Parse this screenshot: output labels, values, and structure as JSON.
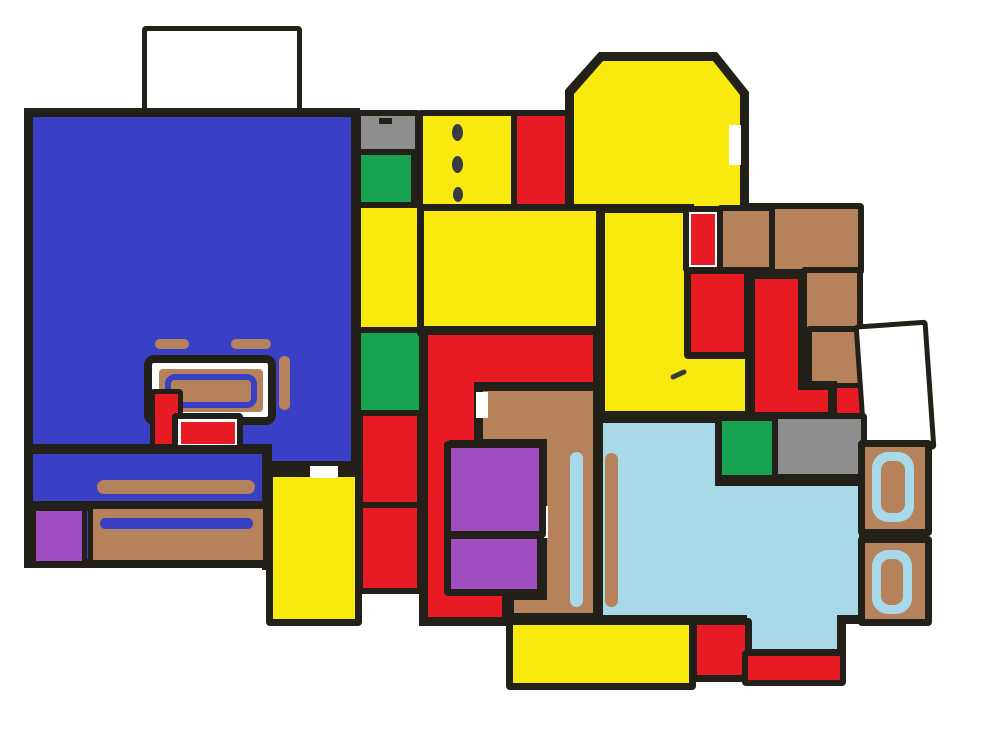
{
  "canvas": {
    "width": 985,
    "height": 749,
    "background": "#ffffff"
  },
  "palette": {
    "wall": "#23201a",
    "blue": "#3a40c6",
    "yellow": "#f8e90e",
    "red": "#e81b24",
    "green": "#17a351",
    "gray": "#8e8e8e",
    "brown": "#b5825c",
    "purple": "#9e4cc0",
    "pool": "#a7d9e9",
    "white": "#ffffff",
    "ink": "#3a3a42"
  },
  "regions": [
    {
      "name": "hatched-area-top",
      "kind": "rect",
      "rect": [
        142,
        26,
        160,
        90
      ],
      "color": "white",
      "border": 5,
      "hatch": "a"
    },
    {
      "name": "blue-great-room",
      "kind": "poly",
      "color": "blue",
      "outer": [
        [
          24,
          108
        ],
        [
          360,
          108
        ],
        [
          360,
          470
        ],
        [
          271,
          470
        ],
        [
          271,
          568
        ],
        [
          24,
          568
        ]
      ],
      "inner": [
        [
          33,
          117
        ],
        [
          351,
          117
        ],
        [
          351,
          461
        ],
        [
          262,
          461
        ],
        [
          262,
          559
        ],
        [
          33,
          559
        ]
      ]
    },
    {
      "name": "yellow-room-bottom-left",
      "kind": "rect",
      "rect": [
        266,
        470,
        96,
        156
      ],
      "color": "yellow",
      "border": 7
    },
    {
      "name": "blue-room-inner-wall-h1",
      "kind": "rect",
      "rect": [
        26,
        444,
        246,
        10
      ],
      "color": "wall"
    },
    {
      "name": "blue-room-inner-wall-h2",
      "kind": "rect",
      "rect": [
        26,
        501,
        246,
        10
      ],
      "color": "wall"
    },
    {
      "name": "blue-room-inner-wall-v",
      "kind": "rect",
      "rect": [
        262,
        444,
        10,
        126
      ],
      "color": "wall"
    },
    {
      "name": "door-gap-yellow-room",
      "kind": "rect",
      "rect": [
        310,
        466,
        28,
        12
      ],
      "color": "white"
    },
    {
      "name": "counter-dash-left",
      "kind": "rect",
      "rect": [
        155,
        339,
        34,
        10
      ],
      "color": "brown",
      "radius": 5
    },
    {
      "name": "counter-dash-right",
      "kind": "rect",
      "rect": [
        231,
        339,
        40,
        10
      ],
      "color": "brown",
      "radius": 5
    },
    {
      "name": "table-outline",
      "kind": "rect",
      "rect": [
        144,
        355,
        132,
        70
      ],
      "color": "white",
      "border": 8,
      "radius": 10
    },
    {
      "name": "table-top",
      "kind": "rect",
      "rect": [
        159,
        369,
        104,
        43
      ],
      "color": "brown",
      "radius": 4
    },
    {
      "name": "table-blue-trim",
      "kind": "rect",
      "rect": [
        165,
        374,
        92,
        34
      ],
      "color": "none",
      "stroke": "blue",
      "sw": 6,
      "radius": 10
    },
    {
      "name": "chair-strip",
      "kind": "rect",
      "rect": [
        279,
        356,
        11,
        54
      ],
      "color": "brown",
      "radius": 5
    },
    {
      "name": "red-cabinet-tall",
      "kind": "rect",
      "rect": [
        150,
        389,
        33,
        60
      ],
      "color": "red",
      "border": 5
    },
    {
      "name": "side-table-outline",
      "kind": "rect",
      "rect": [
        172,
        413,
        71,
        38
      ],
      "color": "white",
      "border": 6,
      "radius": 4
    },
    {
      "name": "side-table-red",
      "kind": "rect",
      "rect": [
        181,
        422,
        54,
        22
      ],
      "color": "red"
    },
    {
      "name": "bench-bar",
      "kind": "rect",
      "rect": [
        97,
        480,
        158,
        14
      ],
      "color": "brown",
      "radius": 7
    },
    {
      "name": "purple-mat-bottom-left",
      "kind": "rect",
      "rect": [
        31,
        506,
        56,
        60
      ],
      "color": "purple",
      "border": 5
    },
    {
      "name": "brown-counter-bottom",
      "kind": "rect",
      "rect": [
        88,
        504,
        180,
        61
      ],
      "color": "brown",
      "border": 5
    },
    {
      "name": "blue-trim-bar",
      "kind": "rect",
      "rect": [
        100,
        518,
        153,
        11
      ],
      "color": "blue",
      "radius": 5
    },
    {
      "name": "gray-cell-top",
      "kind": "rect",
      "rect": [
        355,
        110,
        66,
        45
      ],
      "color": "gray",
      "border": 6
    },
    {
      "name": "gray-cell-mark",
      "kind": "rect",
      "rect": [
        379,
        118,
        13,
        6
      ],
      "color": "wall"
    },
    {
      "name": "green-cell-top",
      "kind": "rect",
      "rect": [
        355,
        149,
        62,
        60
      ],
      "color": "green",
      "border": 6
    },
    {
      "name": "yellow-cell-mid-left",
      "kind": "rect",
      "rect": [
        355,
        202,
        70,
        131
      ],
      "color": "yellow",
      "border": 6
    },
    {
      "name": "green-cell-mid-left",
      "kind": "rect",
      "rect": [
        355,
        327,
        70,
        89
      ],
      "color": "green",
      "border": 6
    },
    {
      "name": "red-cell-upper-left",
      "kind": "rect",
      "rect": [
        357,
        410,
        66,
        98
      ],
      "color": "red",
      "border": 6
    },
    {
      "name": "red-cell-lower-left",
      "kind": "rect",
      "rect": [
        357,
        502,
        66,
        92
      ],
      "color": "red",
      "border": 6
    },
    {
      "name": "yellow-cell-door-dots",
      "kind": "rect",
      "rect": [
        417,
        110,
        101,
        103
      ],
      "color": "yellow",
      "border": 6
    },
    {
      "name": "door-dot-1",
      "kind": "rect",
      "rect": [
        452,
        124,
        11,
        17
      ],
      "color": "ink",
      "radius": "50%"
    },
    {
      "name": "door-dot-2",
      "kind": "rect",
      "rect": [
        452,
        156,
        11,
        17
      ],
      "color": "ink",
      "radius": "50%"
    },
    {
      "name": "door-dot-3",
      "kind": "rect",
      "rect": [
        453,
        187,
        10,
        15
      ],
      "color": "ink",
      "radius": "50%"
    },
    {
      "name": "red-cell-top",
      "kind": "rect",
      "rect": [
        511,
        110,
        63,
        103
      ],
      "color": "red",
      "border": 6
    },
    {
      "name": "sunroom-top-right",
      "kind": "poly",
      "color": "yellow",
      "outer": [
        [
          565,
          207
        ],
        [
          565,
          90
        ],
        [
          599,
          52
        ],
        [
          717,
          52
        ],
        [
          749,
          92
        ],
        [
          749,
          207
        ]
      ],
      "inner": [
        [
          574,
          207
        ],
        [
          574,
          94
        ],
        [
          603,
          61
        ],
        [
          713,
          61
        ],
        [
          740,
          95
        ],
        [
          740,
          207
        ]
      ]
    },
    {
      "name": "sunroom-window-notch",
      "kind": "rect",
      "rect": [
        729,
        125,
        12,
        40
      ],
      "color": "white"
    },
    {
      "name": "sunroom-door-gap",
      "kind": "rect",
      "rect": [
        649,
        199,
        20,
        12
      ],
      "color": "yellow"
    },
    {
      "name": "yellow-room-center",
      "kind": "rect",
      "rect": [
        417,
        204,
        191,
        133
      ],
      "color": "yellow",
      "border": 7
    },
    {
      "name": "yellow-room-tall-L",
      "kind": "poly",
      "color": "yellow",
      "outer": [
        [
          596,
          204
        ],
        [
          694,
          204
        ],
        [
          694,
          348
        ],
        [
          754,
          348
        ],
        [
          754,
          420
        ],
        [
          596,
          420
        ]
      ],
      "inner": [
        [
          605,
          213
        ],
        [
          685,
          213
        ],
        [
          685,
          357
        ],
        [
          745,
          357
        ],
        [
          745,
          411
        ],
        [
          605,
          411
        ]
      ]
    },
    {
      "name": "pencil-check-mark",
      "kind": "rect",
      "rect": [
        670,
        372,
        17,
        5
      ],
      "color": "ink",
      "rotate": -25,
      "radius": 3
    },
    {
      "name": "wall-segment-top-right",
      "kind": "rect",
      "rect": [
        740,
        203,
        38,
        11
      ],
      "color": "wall"
    },
    {
      "name": "red-strip-cell",
      "kind": "rect",
      "rect": [
        683,
        206,
        43,
        67
      ],
      "color": "white",
      "border": 6
    },
    {
      "name": "red-strip",
      "kind": "rect",
      "rect": [
        691,
        214,
        24,
        51
      ],
      "color": "red"
    },
    {
      "name": "brown-room-1",
      "kind": "rect",
      "rect": [
        717,
        205,
        59,
        68
      ],
      "color": "brown",
      "border": 6
    },
    {
      "name": "brown-room-2",
      "kind": "rect",
      "rect": [
        769,
        203,
        95,
        72
      ],
      "color": "brown",
      "border": 6
    },
    {
      "name": "red-room-mid-right",
      "kind": "rect",
      "rect": [
        684,
        267,
        67,
        92
      ],
      "color": "red",
      "border": 7
    },
    {
      "name": "brown-room-3",
      "kind": "rect",
      "rect": [
        801,
        267,
        62,
        67
      ],
      "color": "brown",
      "border": 6
    },
    {
      "name": "brown-room-4",
      "kind": "rect",
      "rect": [
        806,
        326,
        58,
        67
      ],
      "color": "brown",
      "border": 6
    },
    {
      "name": "brown-tab",
      "kind": "rect",
      "rect": [
        858,
        345,
        16,
        30
      ],
      "color": "brown"
    },
    {
      "name": "red-closet",
      "kind": "rect",
      "rect": [
        832,
        383,
        35,
        38
      ],
      "color": "red",
      "border": 5
    },
    {
      "name": "red-room-L-right",
      "kind": "poly",
      "color": "red",
      "outer": [
        [
          746,
          270
        ],
        [
          807,
          270
        ],
        [
          807,
          381
        ],
        [
          837,
          381
        ],
        [
          837,
          421
        ],
        [
          746,
          421
        ]
      ],
      "inner": [
        [
          755,
          279
        ],
        [
          798,
          279
        ],
        [
          798,
          390
        ],
        [
          828,
          390
        ],
        [
          828,
          412
        ],
        [
          755,
          412
        ]
      ]
    },
    {
      "name": "hatched-area-right",
      "kind": "rect",
      "rect": [
        858,
        322,
        74,
        130
      ],
      "color": "white",
      "border": 5,
      "hatch": "b",
      "rotate": -4
    },
    {
      "name": "red-hall-C-center",
      "kind": "poly",
      "color": "red",
      "outer": [
        [
          419,
          326
        ],
        [
          602,
          326
        ],
        [
          602,
          393
        ],
        [
          486,
          393
        ],
        [
          486,
          449
        ],
        [
          458,
          449
        ],
        [
          458,
          587
        ],
        [
          511,
          587
        ],
        [
          511,
          626
        ],
        [
          419,
          626
        ]
      ],
      "inner": [
        [
          428,
          335
        ],
        [
          593,
          335
        ],
        [
          593,
          384
        ],
        [
          477,
          384
        ],
        [
          477,
          440
        ],
        [
          449,
          440
        ],
        [
          449,
          596
        ],
        [
          502,
          596
        ],
        [
          502,
          617
        ],
        [
          428,
          617
        ]
      ]
    },
    {
      "name": "brown-hall-L-center",
      "kind": "poly",
      "color": "brown",
      "outer": [
        [
          474,
          382
        ],
        [
          602,
          382
        ],
        [
          602,
          622
        ],
        [
          505,
          622
        ],
        [
          505,
          591
        ],
        [
          538,
          591
        ],
        [
          538,
          448
        ],
        [
          474,
          448
        ]
      ],
      "inner": [
        [
          483,
          391
        ],
        [
          593,
          391
        ],
        [
          593,
          613
        ],
        [
          514,
          613
        ],
        [
          514,
          600
        ],
        [
          547,
          600
        ],
        [
          547,
          439
        ],
        [
          483,
          439
        ]
      ]
    },
    {
      "name": "brown-room-door-gap",
      "kind": "rect",
      "rect": [
        476,
        392,
        12,
        26
      ],
      "color": "white"
    },
    {
      "name": "hall-door-gap",
      "kind": "rect",
      "rect": [
        539,
        506,
        9,
        32
      ],
      "color": "white"
    },
    {
      "name": "purple-room-1",
      "kind": "rect",
      "rect": [
        444,
        441,
        102,
        97
      ],
      "color": "purple",
      "border": 7
    },
    {
      "name": "purple-room-2",
      "kind": "rect",
      "rect": [
        444,
        532,
        100,
        64
      ],
      "color": "purple",
      "border": 7
    },
    {
      "name": "pool-room",
      "kind": "poly",
      "color": "pool",
      "outer": [
        [
          594,
          414
        ],
        [
          724,
          414
        ],
        [
          724,
          477
        ],
        [
          868,
          477
        ],
        [
          868,
          624
        ],
        [
          846,
          624
        ],
        [
          846,
          658
        ],
        [
          738,
          658
        ],
        [
          738,
          624
        ],
        [
          594,
          624
        ]
      ],
      "inner": [
        [
          603,
          423
        ],
        [
          715,
          423
        ],
        [
          715,
          486
        ],
        [
          859,
          486
        ],
        [
          859,
          615
        ],
        [
          837,
          615
        ],
        [
          837,
          649
        ],
        [
          747,
          649
        ],
        [
          747,
          615
        ],
        [
          603,
          615
        ]
      ]
    },
    {
      "name": "green-cell-pool",
      "kind": "rect",
      "rect": [
        716,
        415,
        68,
        66
      ],
      "color": "green",
      "border": 6
    },
    {
      "name": "gray-cell-pool",
      "kind": "rect",
      "rect": [
        772,
        413,
        95,
        67
      ],
      "color": "gray",
      "border": 6
    },
    {
      "name": "hall-lane-stripe",
      "kind": "rect",
      "rect": [
        570,
        452,
        13,
        155
      ],
      "color": "pool",
      "radius": 7
    },
    {
      "name": "pool-lane-stripe",
      "kind": "rect",
      "rect": [
        605,
        453,
        13,
        154
      ],
      "color": "brown",
      "radius": 7
    },
    {
      "name": "yellow-strip-bottom",
      "kind": "rect",
      "rect": [
        506,
        618,
        190,
        72
      ],
      "color": "yellow",
      "border": 7
    },
    {
      "name": "red-room-bottom",
      "kind": "rect",
      "rect": [
        690,
        618,
        62,
        64
      ],
      "color": "red",
      "border": 7
    },
    {
      "name": "red-strip-bottom",
      "kind": "rect",
      "rect": [
        742,
        650,
        104,
        36
      ],
      "color": "red",
      "border": 6
    },
    {
      "name": "bath-cell-1",
      "kind": "rect",
      "rect": [
        858,
        440,
        74,
        96
      ],
      "color": "brown",
      "border": 7
    },
    {
      "name": "bath-fixture-1",
      "kind": "ring",
      "rect": [
        872,
        452,
        42,
        70
      ]
    },
    {
      "name": "bath-cell-2",
      "kind": "rect",
      "rect": [
        858,
        536,
        74,
        90
      ],
      "color": "brown",
      "border": 7
    },
    {
      "name": "bath-fixture-2",
      "kind": "ring",
      "rect": [
        872,
        550,
        40,
        64
      ]
    }
  ]
}
